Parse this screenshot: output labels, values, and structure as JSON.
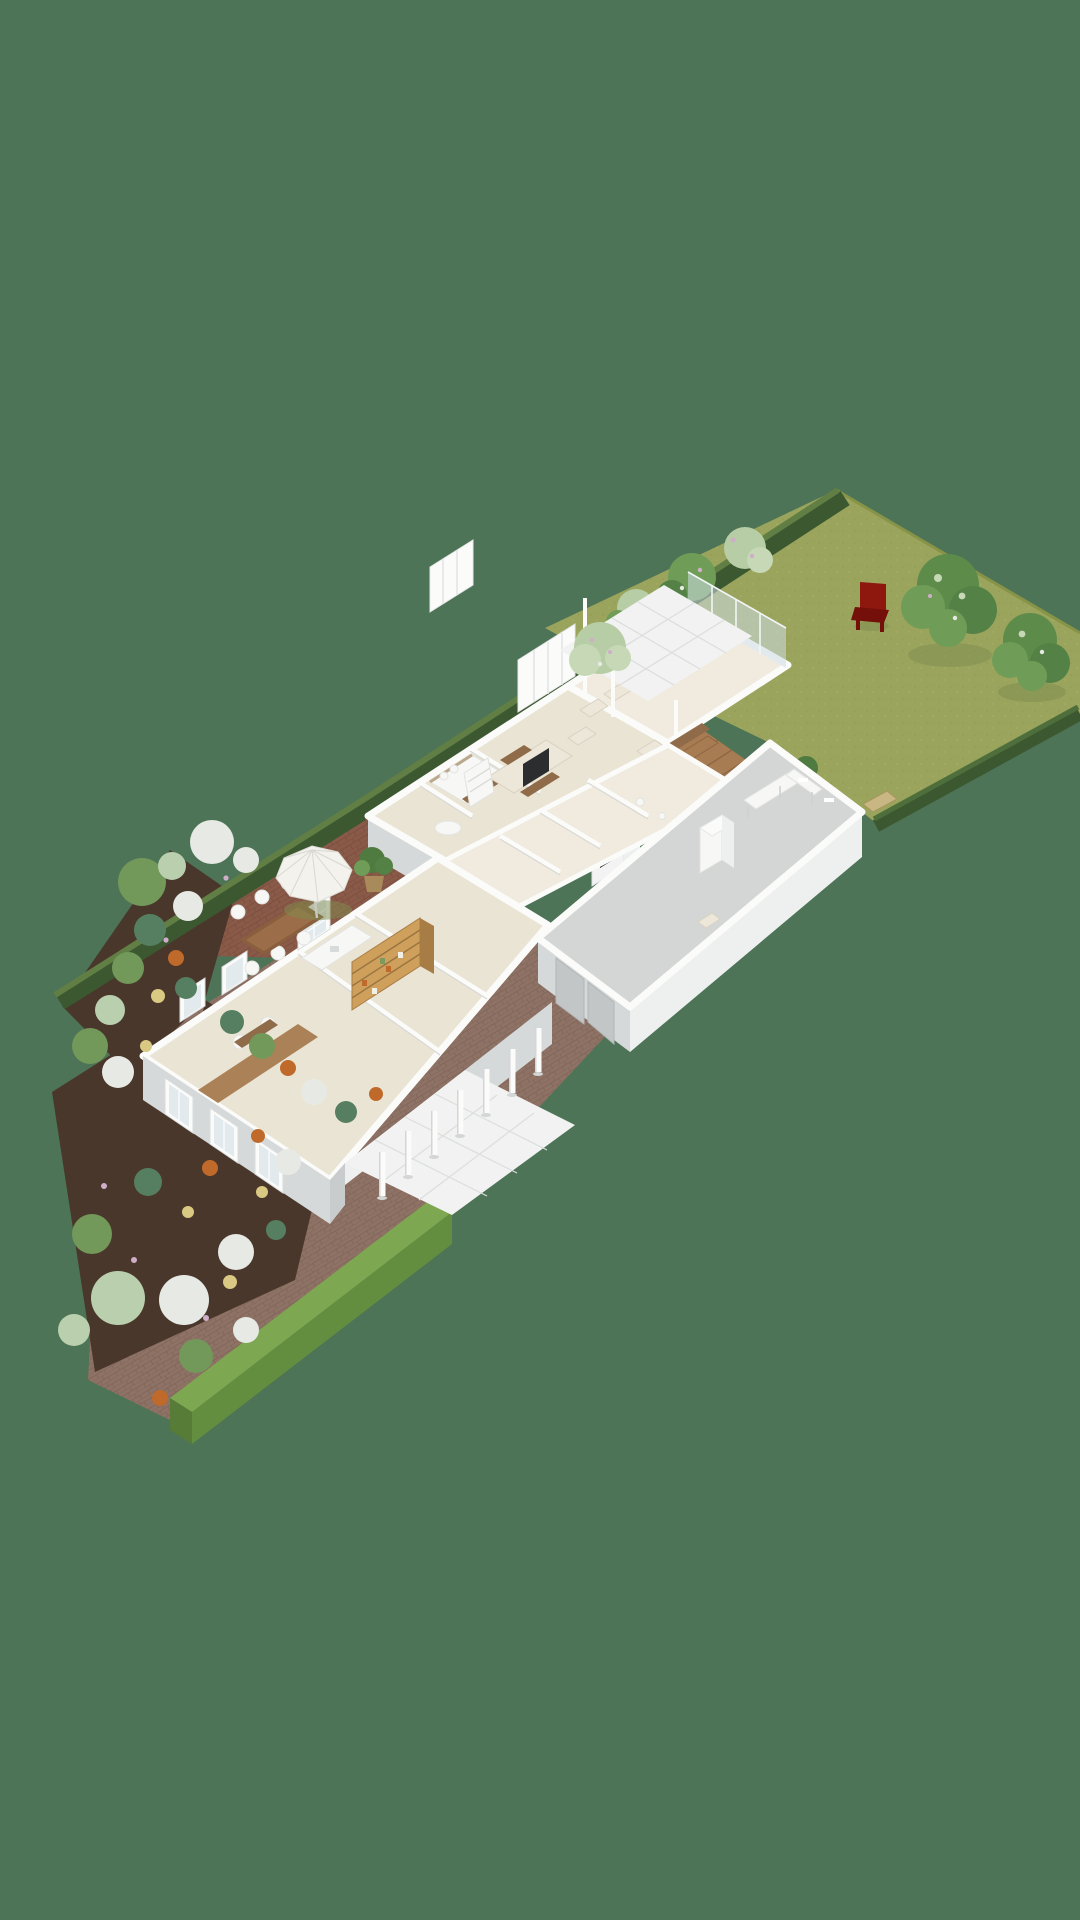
{
  "meta": {
    "type": "isometric-3d-site-plan",
    "description": "Top-down isometric 3D rendering of a single-storey house on a long narrow garden plot"
  },
  "palette": {
    "background": "#4d7456",
    "lawn": "#9aa45c",
    "lawn_shade": "#879448",
    "lawn_dot": "#8f9b53",
    "hedge_dark": "#3c5830",
    "hedge_mid": "#4e6f3c",
    "hedge_light": "#617f44",
    "hedge_bright_top": "#7da750",
    "hedge_bright_face": "#648e3f",
    "hedge_bright_end": "#577c38",
    "soil": "#4a372b",
    "brick_patio": "#8a5a49",
    "path": "#8e7265",
    "wall_white": "#fbfbfa",
    "facade_light": "#eef0f0",
    "facade": "#d6d9da",
    "facade_dark": "#c9cccd",
    "floor": "#eae4d4",
    "floor_light": "#f0ebde",
    "garage_floor": "#d4d6d6",
    "tile": "#f1f2f1",
    "tile_line": "#dcdedd",
    "glass": "#cddde3",
    "wood_deck": "#a87c52",
    "wood_deck_dark": "#8d6742",
    "wood_table": "#8a5f3e",
    "wood_desk": "#ab8157",
    "wood_shelf": "#cfa05c",
    "wood_dark": "#8f6b4a",
    "cream": "#ece7d9",
    "cream_line": "#d8d2c2",
    "tv": "#2c2d2e",
    "fire": "#d07030",
    "fire_dark": "#1d1d1d",
    "red_chair": "#8e170e",
    "red_chair_dark": "#740f09",
    "tree_green": "#5d8b4a",
    "tree_green_2": "#6f9d58",
    "tree_green_3": "#548145",
    "tree_pale": "#b7cda5",
    "tree_pale_2": "#c6d8b6",
    "bush_dark": "#4f7a40",
    "flower_white": "#e7eae4",
    "flower_green": "#72985a",
    "flower_teal": "#557f60",
    "flower_orange": "#bf6a2a",
    "flower_yellow": "#d9c983",
    "flower_pink": "#cfaec9",
    "flower_pale": "#b9cfae",
    "gate": "#c8b683",
    "umbrella": "#f3f2ed",
    "umbrella_rib": "#d8d7d1",
    "window_pane": "#e2eaee",
    "shadow": "#7e8c4e"
  },
  "scene": {
    "backyard": {
      "lawn": true,
      "trees": 2,
      "red_garden_chair": 1,
      "boundary_hedges": true,
      "hedge_gate": 1,
      "small_bush": 1
    },
    "house": {
      "rooms_visible": [
        "bedroom",
        "bathroom",
        "tv-room",
        "lounge-with-fireplace",
        "sunroom",
        "hallway",
        "kitchen",
        "pantry",
        "office"
      ],
      "sunroom_glass_walls": true,
      "clerestory_wall_fins": 2
    },
    "north_terrace": {
      "white_tiles": true,
      "posts": 3,
      "armchairs": 3,
      "small_pale_tree": 1,
      "wood_deck_with_bench": true
    },
    "patio": {
      "parasol": 1,
      "wood_dining_table": 1,
      "round_white_chairs": 6,
      "potted_plant": 1
    },
    "front_terrace": {
      "white_tiles": true,
      "pillars": 7
    },
    "garage": {
      "grey_floor": true,
      "tall_white_cabinet": 1,
      "corner_desk": 1,
      "small_chair": 1,
      "doors_on_side": 2
    },
    "garden": {
      "flower_beds": true,
      "brick_paths": true,
      "white_hydrangeas": true,
      "orange_flowers": true,
      "yellow_flowers": true,
      "bottom_hedge_wall": true
    }
  }
}
